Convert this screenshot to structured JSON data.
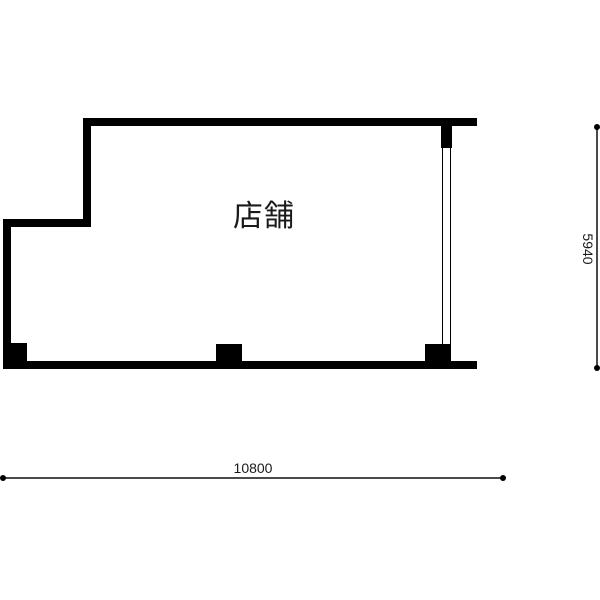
{
  "floor_plan": {
    "room": {
      "label": "店舗"
    },
    "dimension_width": {
      "value": "10800"
    },
    "dimension_height": {
      "value": "5940"
    },
    "colors": {
      "wall": "#000000",
      "dimension_line": "#4a4a4a",
      "text": "#1a1a1a",
      "background": "#ffffff"
    }
  }
}
